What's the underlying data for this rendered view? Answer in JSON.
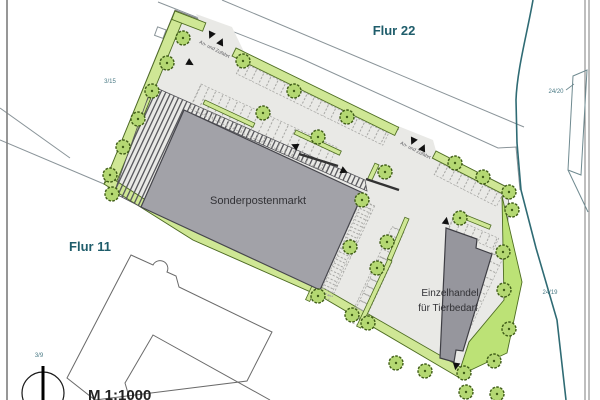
{
  "map": {
    "region_labels": {
      "flur_22": "Flur 22",
      "flur_11": "Flur 11"
    },
    "parcel_labels": {
      "parcel_3_15": "3/15",
      "parcel_24_20": "24/20",
      "parcel_24_19": "24/19",
      "parcel_3_9": "3/9"
    },
    "buildings": {
      "sonderpostenmarkt": "Sonderpostenmarkt",
      "einzelhandel_line1": "Einzelhandel",
      "einzelhandel_line2": "für Tierbedarf"
    },
    "access": {
      "entrance_north_label": "An- und Zufahrt",
      "entrance_east_label": "An- und Zufahrt"
    },
    "scale_label": "M 1:1000",
    "colors": {
      "green_strip": "#cfe795",
      "green_area": "#bce276",
      "tree_fill": "#b4d872",
      "paving": "#e9e9e6",
      "building_gray": "#a2a2a8",
      "boundary_teal": "#2f6b74",
      "label_teal": "#1f5d6b"
    }
  }
}
